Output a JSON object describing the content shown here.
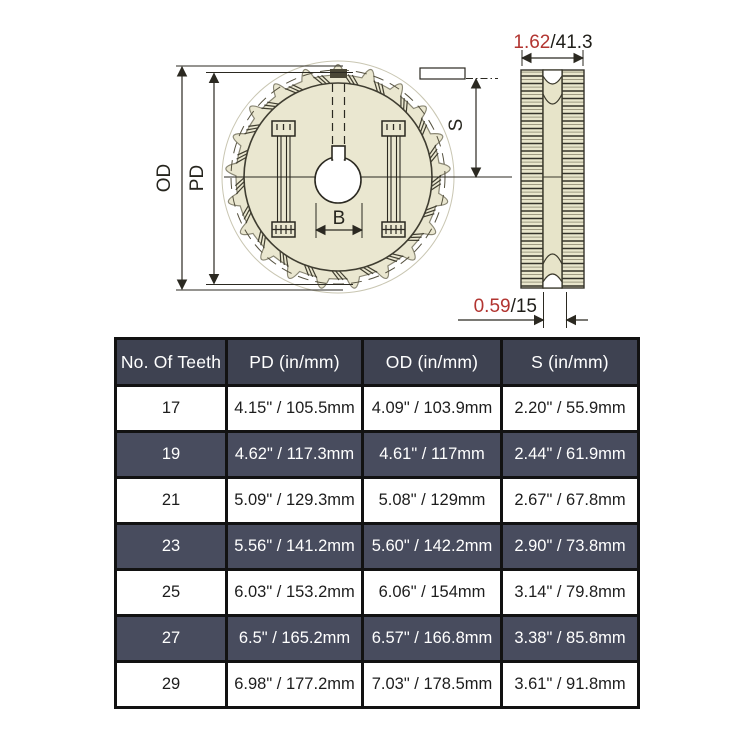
{
  "diagram": {
    "front_view": {
      "label_od": "OD",
      "label_pd": "PD",
      "label_b": "B",
      "label_s": "S"
    },
    "side_view": {
      "dim_width": {
        "inches": "1.62",
        "slash_mm": "/41.3"
      },
      "dim_hub": {
        "inches": "0.59",
        "slash_mm": "/15"
      }
    },
    "colors": {
      "accent_red": "#b23531",
      "sprocket_fill": "#eae7d0",
      "line_dark": "#2b2921"
    }
  },
  "table": {
    "headers": [
      "No. Of Teeth",
      "PD (in/mm)",
      "OD (in/mm)",
      "S (in/mm)"
    ],
    "rows": [
      [
        "17",
        "4.15\" / 105.5mm",
        "4.09\" / 103.9mm",
        "2.20\" / 55.9mm"
      ],
      [
        "19",
        "4.62\" / 117.3mm",
        "4.61\" / 117mm",
        "2.44\" / 61.9mm"
      ],
      [
        "21",
        "5.09\" / 129.3mm",
        "5.08\" / 129mm",
        "2.67\" / 67.8mm"
      ],
      [
        "23",
        "5.56\" / 141.2mm",
        "5.60\" / 142.2mm",
        "2.90\" / 73.8mm"
      ],
      [
        "25",
        "6.03\" / 153.2mm",
        "6.06\" / 154mm",
        "3.14\" / 79.8mm"
      ],
      [
        "27",
        "6.5\" / 165.2mm",
        "6.57\" / 166.8mm",
        "3.38\" / 85.8mm"
      ],
      [
        "29",
        "6.98\" / 177.2mm",
        "7.03\" / 178.5mm",
        "3.61\" / 91.8mm"
      ]
    ],
    "colors": {
      "header_bg": "#3e4251",
      "row_dark_bg": "#484c5e",
      "row_light_bg": "#ffffff",
      "border": "#121212"
    }
  }
}
